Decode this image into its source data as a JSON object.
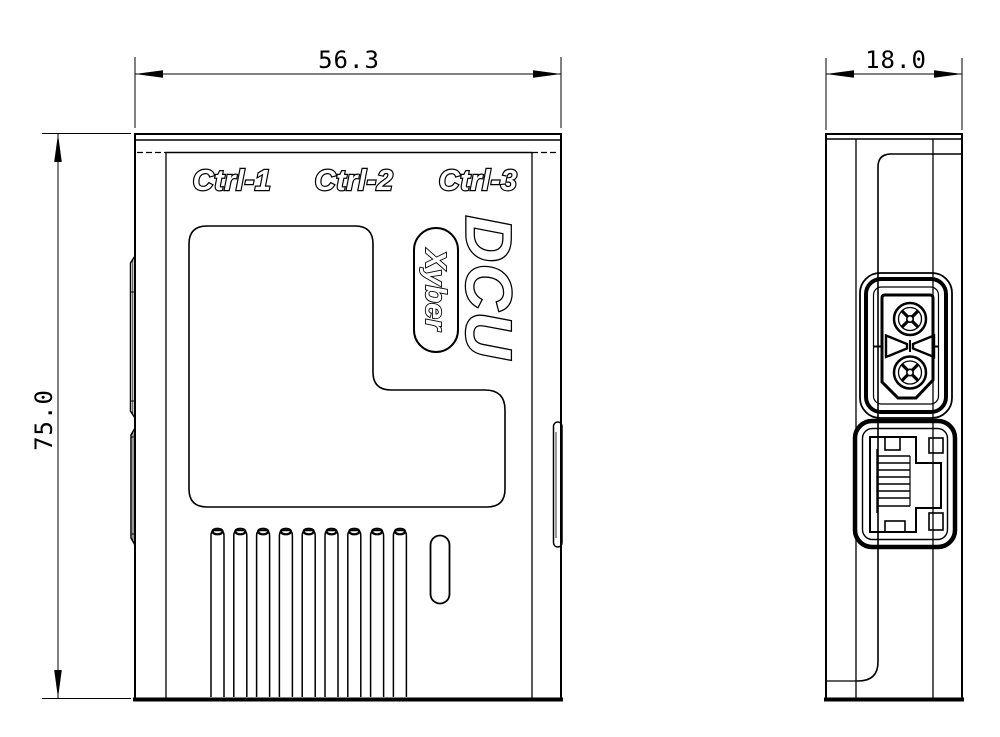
{
  "views": {
    "front": {
      "port_labels": [
        "Ctrl-1",
        "Ctrl-2",
        "Ctrl-3"
      ],
      "product_logo": "DCU",
      "brand": "Xyber",
      "width_mm": "56.3",
      "height_mm": "75.0"
    },
    "side": {
      "depth_mm": "18.0"
    }
  },
  "colors": {
    "line": "#000000",
    "background": "#ffffff"
  }
}
